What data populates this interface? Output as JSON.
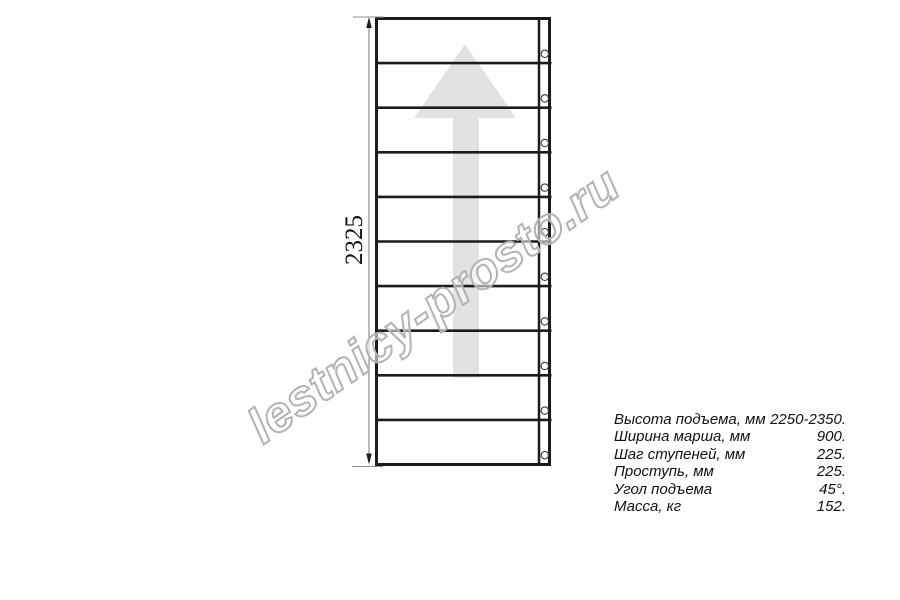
{
  "drawing": {
    "dimension_label": "2325",
    "steps_count": 10,
    "direction_arrow": "up-arrow"
  },
  "watermark": {
    "text": "lestnicy-prosto.ru"
  },
  "specs": {
    "rows": [
      {
        "label": "Высота подъема, мм",
        "value": "2250-2350."
      },
      {
        "label": "Ширина марша, мм",
        "value": "900."
      },
      {
        "label": "Шаг ступеней, мм",
        "value": "225."
      },
      {
        "label": "Проступь, мм",
        "value": "225."
      },
      {
        "label": "Угол подъема",
        "value": "45°."
      },
      {
        "label": "Масса, кг",
        "value": "152."
      }
    ]
  },
  "colors": {
    "line": "#1c1c1c",
    "thin_line": "#8f8f8f",
    "hole_stroke": "#3a3a3a",
    "arrow_fill": "#e2e2e2",
    "watermark_stroke": "#b3b3b3",
    "text": "#111111"
  }
}
